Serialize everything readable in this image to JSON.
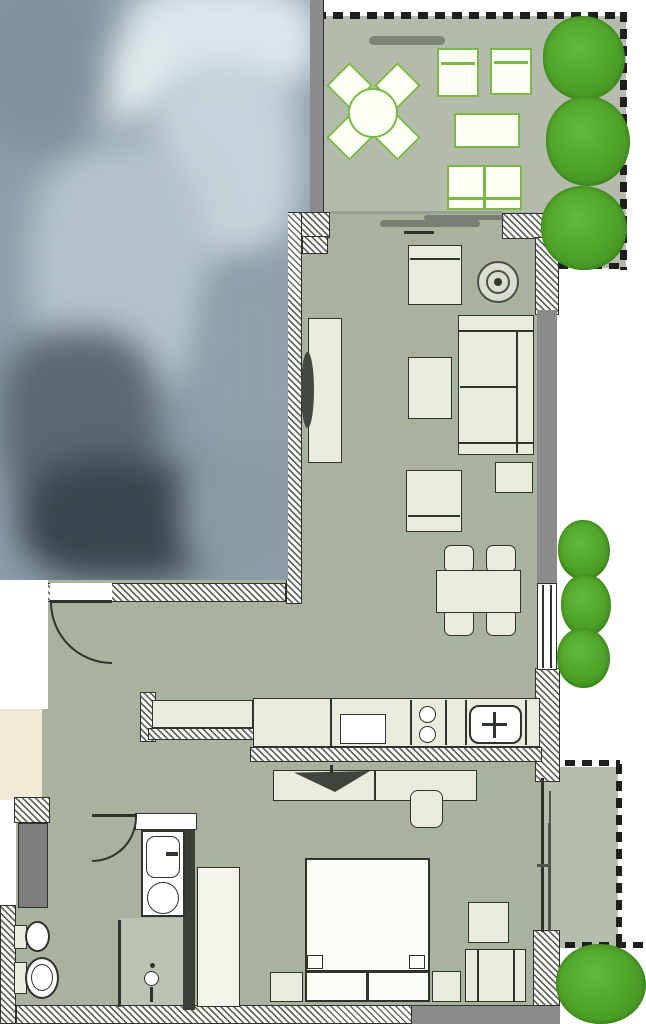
{
  "meta": {
    "drawing_type": "architectural floor plan, top view, partially blurred",
    "canvas": {
      "width_px": 646,
      "height_px": 1024
    }
  },
  "labels": {
    "entrance_label": "B"
  },
  "rooms": {
    "terrace": {
      "name": "terrace",
      "furniture": [
        "round-dining-table",
        "terrace-chair x4",
        "sun-lounger x2",
        "coffee-table",
        "two-seat-bench"
      ],
      "landscaping": [
        "hedge-tree x3",
        "boundary-dashed-line"
      ]
    },
    "living-room": {
      "name": "living-room",
      "furniture": [
        "armchair",
        "lounge-chair",
        "lounge-chair-2",
        "round-pouf",
        "sofa",
        "side-table",
        "dining-table",
        "dining-chair x4",
        "tv-sideboard",
        "tv"
      ]
    },
    "kitchen": {
      "name": "kitchen",
      "furniture": [
        "counter-left",
        "counter-main",
        "dishwasher",
        "cooktop-2-burner",
        "kitchen-sink"
      ]
    },
    "bedroom": {
      "name": "bedroom",
      "furniture": [
        "desk-sideboard",
        "tv-flat",
        "desk-chair",
        "double-bed",
        "nightstand x2",
        "side-table",
        "armchair",
        "wardrobe",
        "plant"
      ]
    },
    "bathroom": {
      "name": "bathroom",
      "furniture": [
        "vanity-sink",
        "washing-machine",
        "toilet",
        "bidet",
        "shower-with-drain",
        "tall-cabinet"
      ]
    },
    "hall": {
      "name": "entrance-hall",
      "furniture": [
        "entrance-door"
      ]
    }
  },
  "colors": {
    "floor_interior": "#a9b29e",
    "floor_terrace": "#b4bbac",
    "floor_shower": "#bdc3b4",
    "floor_outdoor_strip": "#b6bdad",
    "wall_solid_grey": "#8b8b8b",
    "wall_dark": "#3a3f38",
    "outline": "#2e332c",
    "furniture_fill": "#e9ebde",
    "terrace_furniture_fill": "#fcfff4",
    "terrace_furniture_border": "#7cb845",
    "tree_green": "#4ea228",
    "tree_green_dark": "#3d8c1e",
    "beige_area": "#efe9d5",
    "blur_base": "#8c9eaa"
  }
}
